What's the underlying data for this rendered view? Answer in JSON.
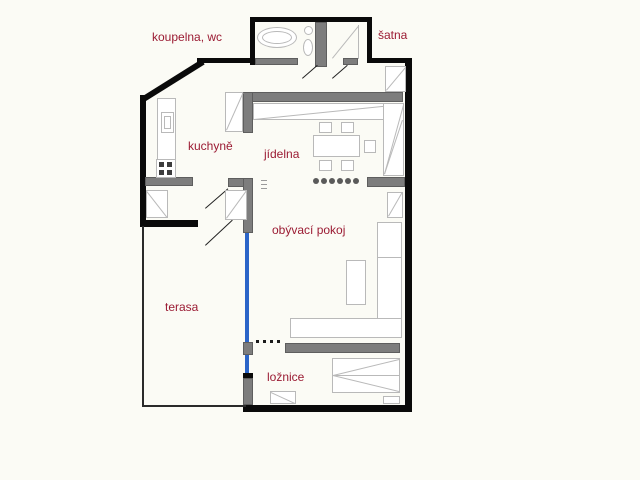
{
  "title": "apartment floor plan",
  "colors": {
    "label": "#9b1b33",
    "wall": "#0a0a0a",
    "inner_wall": "#7d7d7d",
    "glass": "#2b65c8",
    "furniture": "#b9b9b9"
  },
  "rooms": {
    "bathroom": {
      "label": "koupelna, wc"
    },
    "dressing": {
      "label": "šatna"
    },
    "kitchen": {
      "label": "kuchyně"
    },
    "dining": {
      "label": "jídelna"
    },
    "living": {
      "label": "obývací pokoj"
    },
    "terrace": {
      "label": "terasa"
    },
    "bedroom": {
      "label": "ložnice"
    }
  }
}
